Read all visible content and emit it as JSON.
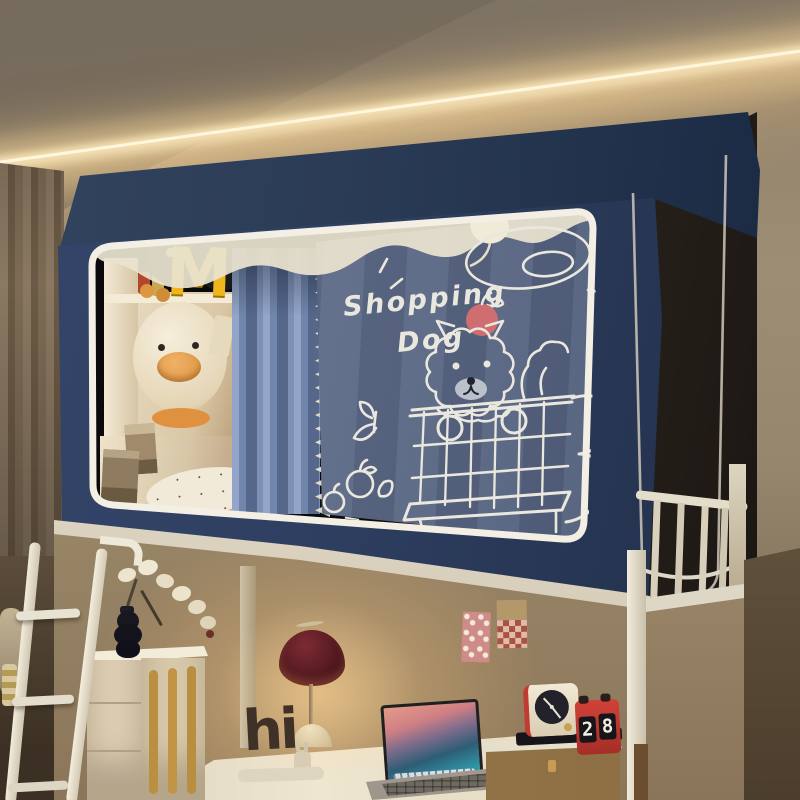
{
  "scene_label": "dorm loft bed with printed bed-canopy tent, desk nook below",
  "canopy": {
    "print_line1": "Shopping",
    "print_line2": "Dog",
    "shell_navy": "#2e3f5e",
    "fabric_slate": "#5d6b88",
    "piping_cream": "#f2eee2",
    "doodle_ink": "#eae8de",
    "apple_red": "#cf6d70"
  },
  "shelf": {
    "arch_letter": "M",
    "arch_color": "#eeb51d"
  },
  "desk": {
    "hi_text": "hi"
  },
  "clock": {
    "flip_left": "2",
    "flip_right": "8",
    "calendar_red": "#c23b33"
  }
}
